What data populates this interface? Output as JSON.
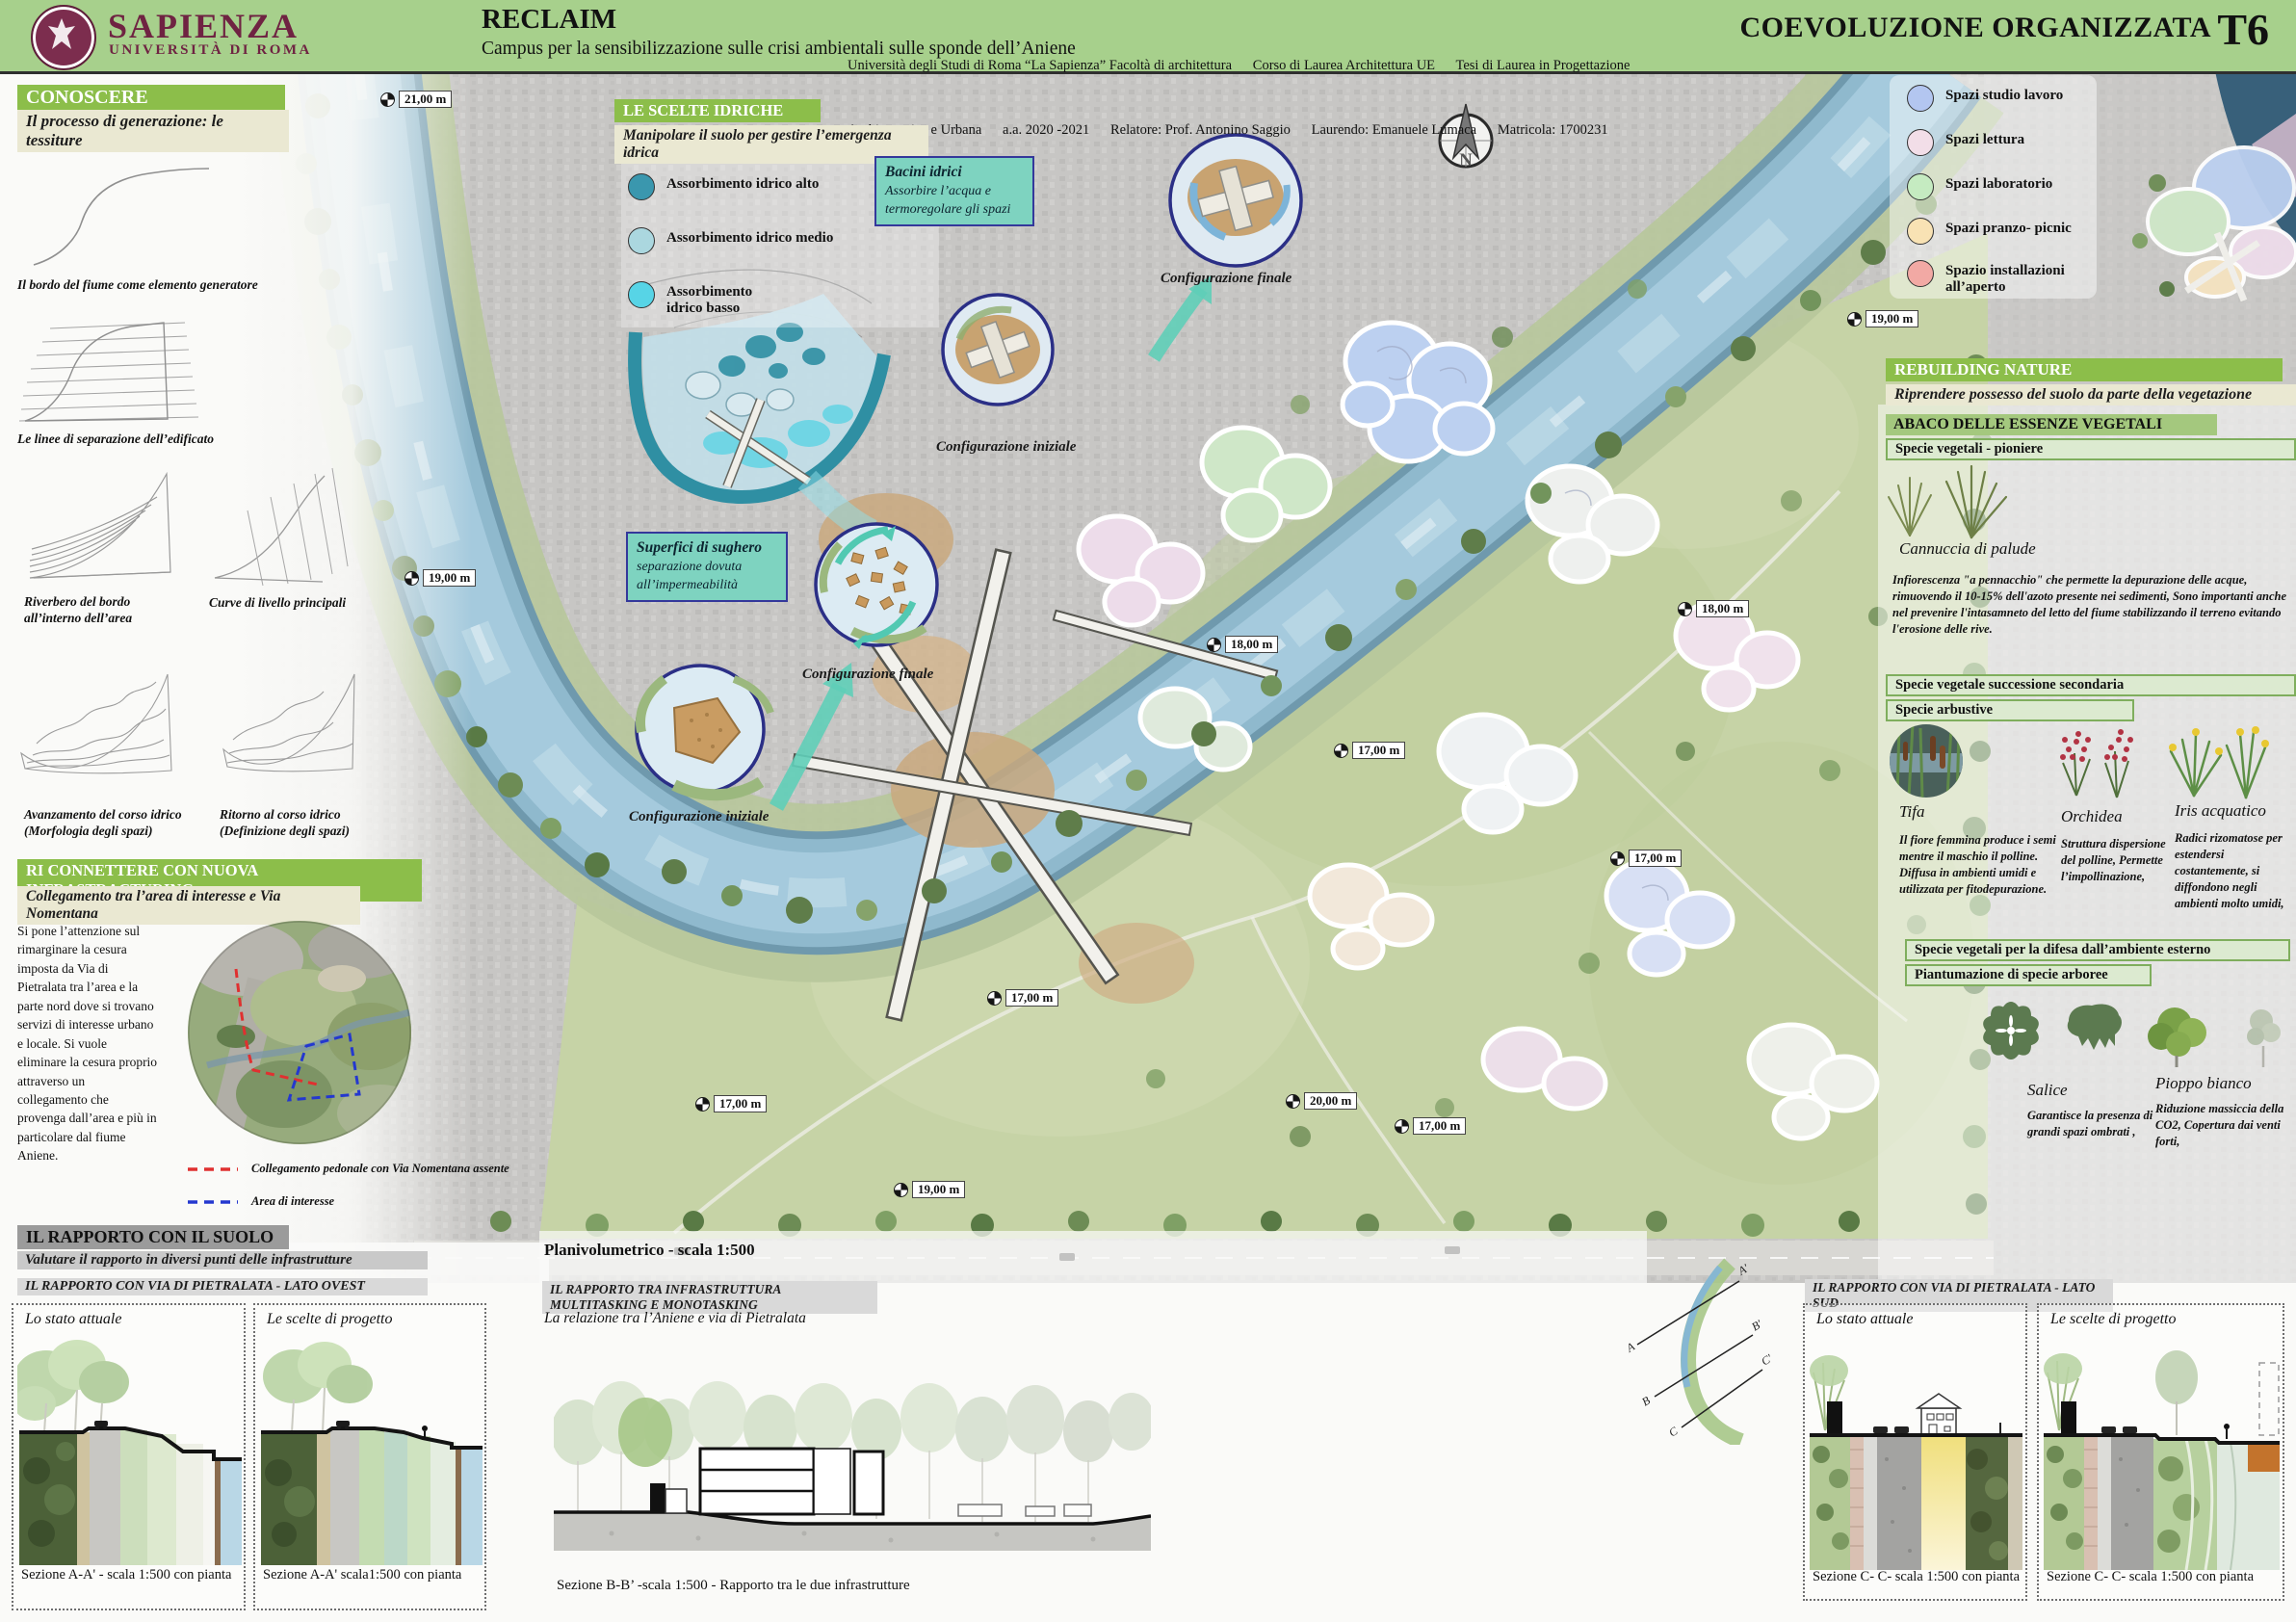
{
  "header": {
    "logo_title": "SAPIENZA",
    "logo_subtitle": "UNIVERSITÀ DI ROMA",
    "project_title": "RECLAIM",
    "project_subtitle": "Campus per la sensibilizzazione sulle crisi ambientali sulle sponde dell’Aniene",
    "credits_line1": "Università degli Studi di Roma “La Sapienza” Facoltà di architettura      Corso di Laurea Architettura UE      Tesi di Laurea in Progettazione",
    "credits_line2": "Architettonica e Urbana      a.a. 2020 -2021      Relatore: Prof. Antonino Saggio      Laurendo: Emanuele Lumaca      Matricola: 1700231",
    "board_title": "COEVOLUZIONE ORGANIZZATA",
    "board_code": "T6"
  },
  "soil_section": {
    "title": "CONOSCERE L’ELEMENTO SUOLO",
    "subtitle": "Il processo di generazione: le tessiture",
    "label_bordo": "Il bordo del fiume come elemento generatore",
    "label_linee": "Le linee di separazione dell’edificato",
    "label_riverbero": "Riverbero del bordo all’interno dell’area",
    "label_curve": "Curve di livello principali",
    "label_avanzamento": "Avanzamento del corso idrico (Morfologia degli spazi)",
    "label_ritorno": "Ritorno al corso idrico (Definizione degli spazi)"
  },
  "connect_section": {
    "title": "RI CONNETTERE CON NUOVA INFRASTRACTURING",
    "subtitle": "Collegamento tra l’area di interesse e Via Nomentana",
    "body": "Si pone l’attenzione sul rimarginare la cesura imposta da Via di Pietralata tra l’area e la parte nord dove si trovano servizi di interesse urbano e locale. Si vuole eliminare la cesura proprio attraverso un collegamento che provenga dall’area e più in particolare dal fiume Aniene.",
    "legend": [
      {
        "label": "Collegamento pedonale con Via Nomentana assente",
        "color": "#e03030"
      },
      {
        "label": "Area di interesse",
        "color": "#2438cf"
      }
    ]
  },
  "water_section": {
    "title": "LE SCELTE IDRICHE",
    "subtitle": "Manipolare il suolo per gestire l’emergenza idrica",
    "legend": [
      {
        "label": "Assorbimento idrico alto",
        "color": "#3a97ae"
      },
      {
        "label": "Assorbimento idrico medio",
        "color": "#abd7df"
      },
      {
        "label": "Assorbimento idrico basso",
        "color": "#57d4e6"
      }
    ],
    "bacini_title": "Bacini idrici",
    "bacini_body": "Assorbire l’acqua e termoregolare gli spazi",
    "sughero_title": "Superfici di sughero",
    "sughero_body": "separazione dovuta all’impermeabilità",
    "config_iniziale": "Configurazione iniziale",
    "config_finale": "Configurazione finale"
  },
  "spaces_legend": [
    {
      "label": "Spazi studio lavoro",
      "color": "#b3c6f0"
    },
    {
      "label": "Spazi lettura",
      "color": "#f2dee8"
    },
    {
      "label": "Spazi laboratorio",
      "color": "#c5ebc1"
    },
    {
      "label": "Spazi pranzo- picnic",
      "color": "#f8e2b4"
    },
    {
      "label": "Spazio installazioni all’aperto",
      "color": "#f2a9a4"
    }
  ],
  "nature_section": {
    "title": "REBUILDING NATURE",
    "subtitle": "Riprendere possesso del suolo da parte della vegetazione",
    "abaco_title": "ABACO DELLE ESSENZE VEGETALI",
    "pioneer_title": "Specie vegetali - pioniere",
    "cannuccia_name": "Cannuccia di palude",
    "cannuccia_desc": "Infiorescenza \"a pennacchio\" che permette la depurazione delle acque, rimuovendo il 10-15% dell'azoto presente nei sedimenti, Sono importanti anche nel prevenire l'intasamneto del letto del fiume stabilizzando il terreno evitando l'erosione delle rive.",
    "secondary_title": "Specie vegetale successione secondaria",
    "shrub_title": "Specie arbustive",
    "species": [
      {
        "name": "Tifa",
        "desc": "Il fiore femmina produce i semi mentre il maschio il polline. Diffusa in ambienti umidi e utilizzata per fitodepurazione."
      },
      {
        "name": "Orchidea",
        "desc": "Struttura dispersione del polline, Permette l’impollinazione,"
      },
      {
        "name": "Iris acquatico",
        "desc": "Radici rizomatose per estendersi costantemente, si diffondono negli ambienti molto umidi,"
      }
    ],
    "defense_title": "Specie vegetali per la difesa dall’ambiente esterno",
    "planting_title": "Piantumazione di specie arboree",
    "trees": [
      {
        "name": "Salice",
        "desc": "Garantisce la presenza di grandi spazi ombrati ,"
      },
      {
        "name": "Pioppo bianco",
        "desc": "Riduzione massiccia della CO2, Copertura dai venti forti,"
      }
    ]
  },
  "plan": {
    "title": "Planivolumetrico - scala 1:500",
    "north_label": "N",
    "elevations": [
      "21,00 m",
      "19,00 m",
      "19,00 m",
      "18,00 m",
      "18,00 m",
      "17,00 m",
      "17,00 m",
      "17,00 m",
      "17,00 m",
      "20,00 m",
      "17,00 m",
      "19,00 m"
    ]
  },
  "bottom": {
    "soil_title": "IL RAPPORTO CON IL SUOLO",
    "soil_subtitle": "Valutare il rapporto in diversi punti delle infrastrutture",
    "west_title": "IL RAPPORTO CON VIA DI PIETRALATA - LATO OVEST",
    "south_title": "IL RAPPORTO CON VIA DI PIETRALATA - LATO SUD",
    "center_title": "IL RAPPORTO TRA INFRASTRUTTURA MULTITASKING E MONOTASKING",
    "center_subtitle": "La relazione tra l’Aniene e via di Pietralata",
    "center_caption": "Sezione B-B’  -scala 1:500 - Rapporto tra le due infrastrutture",
    "state_label": "Lo stato attuale",
    "project_label": "Le scelte di progetto",
    "caption_a1": "Sezione A-A' - scala 1:500 con pianta",
    "caption_a2": "Sezione A-A' scala1:500 con pianta",
    "caption_c": "Sezione C- C- scala 1:500 con pianta",
    "section_letters": [
      "A",
      "B",
      "C",
      "A'",
      "B'",
      "C'"
    ]
  }
}
